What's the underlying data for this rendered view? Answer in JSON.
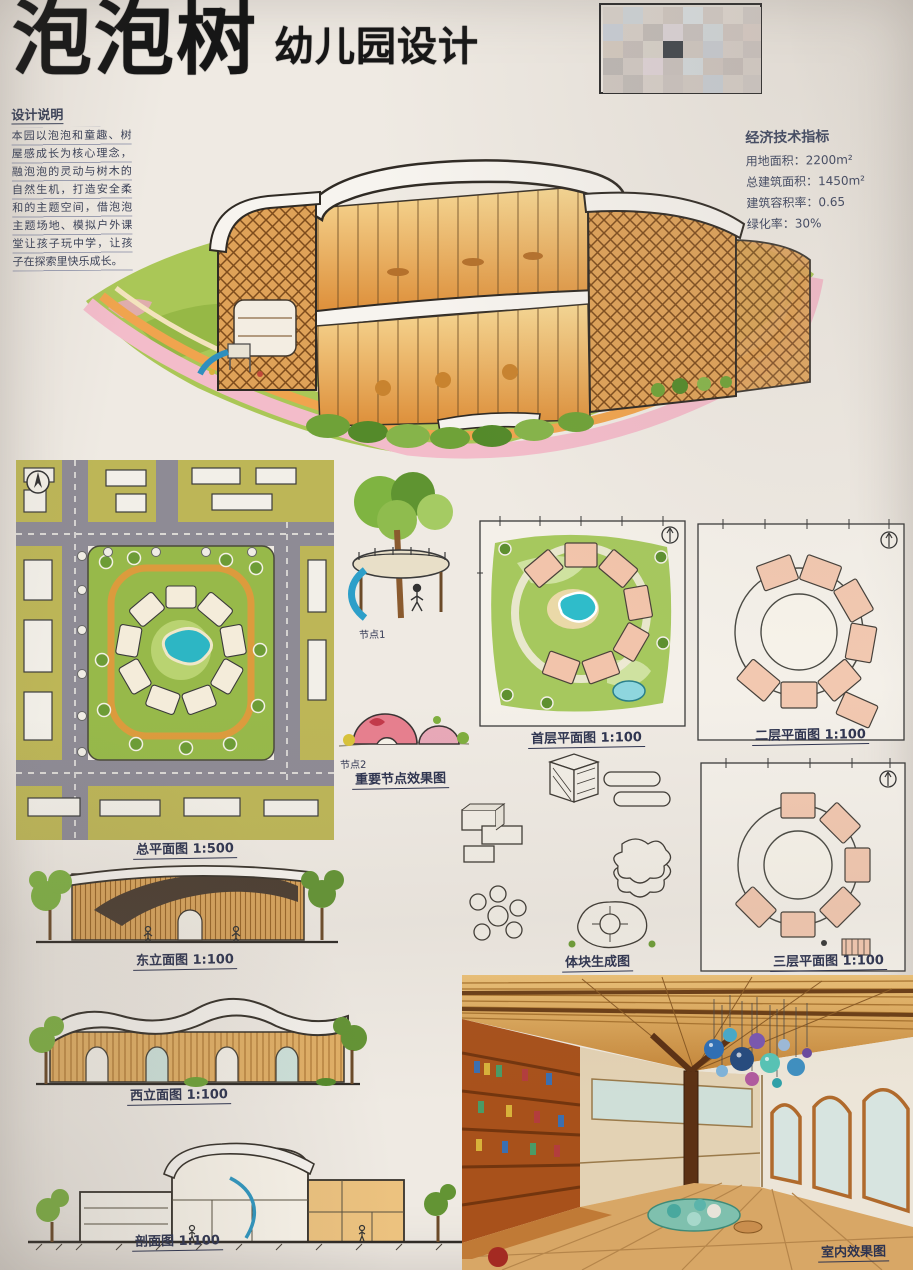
{
  "board": {
    "title": {
      "main": "泡泡树",
      "sub": "幼儿园设计"
    },
    "design_notes": {
      "heading": "设计说明",
      "body": "本园以泡泡和童趣、树屋感成长为核心理念，融泡泡的灵动与树木的自然生机，打造安全柔和的主题空间，借泡泡主题场地、模拟户外课堂让孩子玩中学，让孩子在探索里快乐成长。"
    },
    "indicators": {
      "heading": "经济技术指标",
      "lines": [
        "用地面积：2200m²",
        "总建筑面积：1450m²",
        "建筑容积率：0.65",
        "绿化率：30%"
      ]
    },
    "labels": {
      "site_plan": "总平面图 1:500",
      "node1": "节点1",
      "node2": "节点2",
      "node_renderings": "重要节点效果图",
      "floor1": "首层平面图 1:100",
      "floor2": "二层平面图 1:100",
      "floor3": "三层平面图 1:100",
      "east_elevation": "东立面图 1:100",
      "west_elevation": "西立面图 1:100",
      "section": "剖面图 1:100",
      "massing": "体块生成图",
      "interior": "室内效果图"
    },
    "palette": {
      "paper": "#efeae3",
      "ink": "#343a52",
      "title_black": "#161616",
      "wood": "#d9a45c",
      "lattice": "#dfa258",
      "lawn": "#a6c85e",
      "road_pink": "#f3bcca",
      "road_orange": "#f0a44e",
      "street_gray": "#8e8b95",
      "pond_teal": "#2fbcca",
      "room_pink": "#f2c4ab"
    },
    "icons": {
      "north_arrow": "north-arrow"
    }
  }
}
